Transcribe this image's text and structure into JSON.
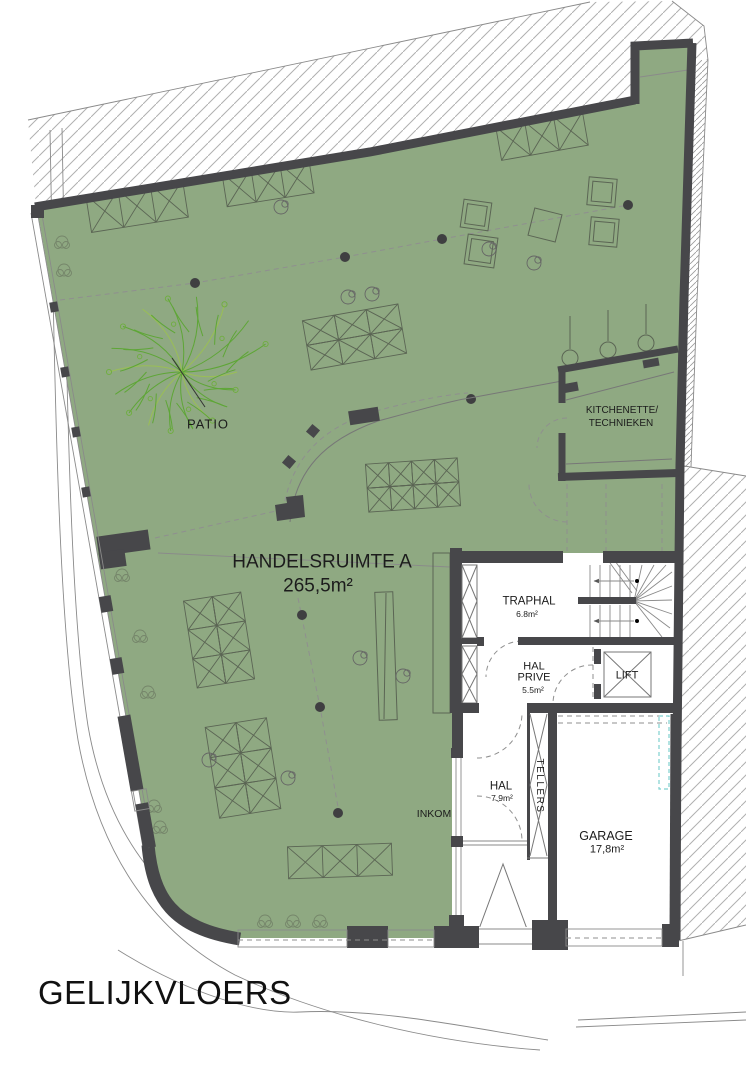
{
  "drawing": {
    "title": "GELIJKVLOERS"
  },
  "rooms": {
    "handelsruimte": {
      "name": "HANDELSRUIMTE A",
      "area": "265,5m²"
    },
    "patio": {
      "name": "PATIO"
    },
    "kitchenette": {
      "line1": "KITCHENETTE/",
      "line2": "TECHNIEKEN"
    },
    "traphal": {
      "name": "TRAPHAL",
      "area": "6.8m²"
    },
    "hal_prive": {
      "line1": "HAL",
      "line2": "PRIVE",
      "area": "5.5m²"
    },
    "lift": {
      "name": "LIFT"
    },
    "hal": {
      "name": "HAL",
      "area": "7.9m²"
    },
    "tellers": {
      "name": "TELLERS"
    },
    "inkom": {
      "name": "INKOM"
    },
    "garage": {
      "name": "GARAGE",
      "area": "17,8m²"
    }
  },
  "colors": {
    "floor_green": "#8FA982",
    "wall_dark": "#47474A",
    "hatch_gray": "#B0B0B0",
    "tree_green": "#5EA636",
    "duct_cyan": "#7FD0CF"
  }
}
